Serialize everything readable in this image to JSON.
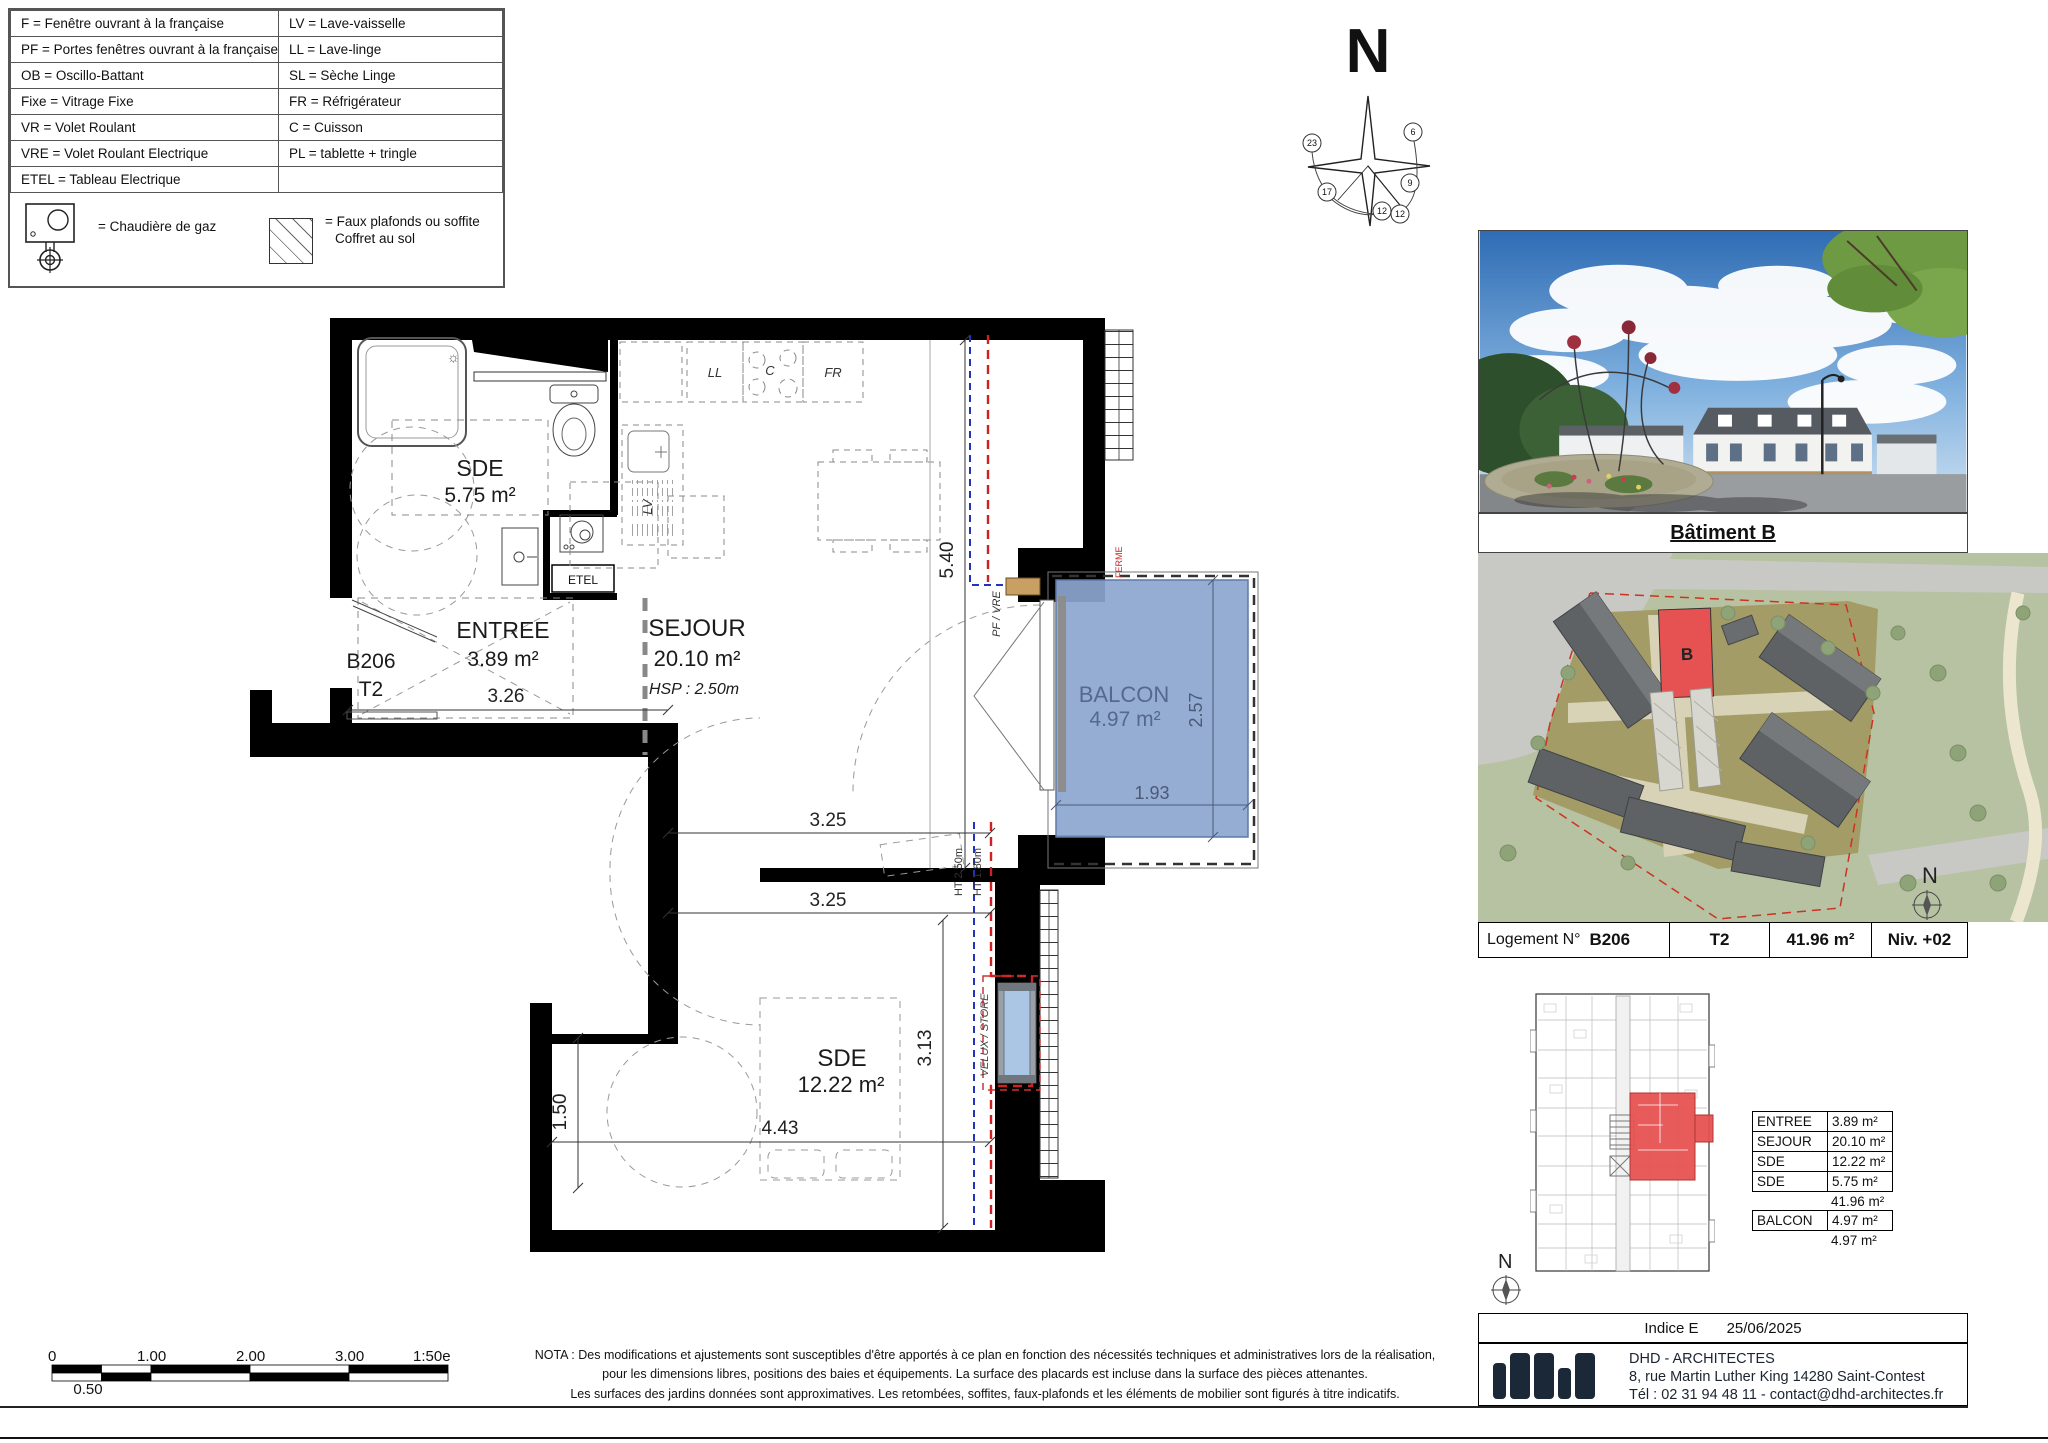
{
  "legend": {
    "rows": [
      {
        "left": "F = Fenêtre ouvrant à la française",
        "right": "LV = Lave-vaisselle"
      },
      {
        "left": "PF = Portes fenêtres ouvrant à la française",
        "right": "LL = Lave-linge"
      },
      {
        "left": "OB = Oscillo-Battant",
        "right": "SL = Sèche Linge"
      },
      {
        "left": "Fixe = Vitrage Fixe",
        "right": "FR = Réfrigérateur"
      },
      {
        "left": "VR = Volet Roulant",
        "right": "C = Cuisson"
      },
      {
        "left": "VRE = Volet Roulant Electrique",
        "right": "PL = tablette + tringle"
      },
      {
        "left": "ETEL = Tableau Electrique",
        "right": ""
      }
    ],
    "boiler": "= Chaudière de gaz",
    "soffit1": "= Faux plafonds ou soffite",
    "soffit2": "Coffret au sol"
  },
  "compass": {
    "north": "N",
    "h23": "23",
    "h6": "6",
    "h17": "17",
    "h9": "9",
    "h12a": "12",
    "h12b": "12"
  },
  "plan": {
    "unit_code": "B206",
    "unit_type": "T2",
    "sde1_name": "SDE",
    "sde1_area": "5.75 m²",
    "entree_name": "ENTREE",
    "entree_area": "3.89 m²",
    "sejour_name": "SEJOUR",
    "sejour_area": "20.10 m²",
    "sejour_hsp": "HSP : 2.50m",
    "sde2_name": "SDE",
    "sde2_area": "12.22 m²",
    "balcon_name": "BALCON",
    "balcon_area": "4.97 m²",
    "etel": "ETEL",
    "ll": "LL",
    "c": "C",
    "fr": "FR",
    "lv": "LV",
    "pf_vre": "PF / VRE",
    "velux": "VELUX / STORE",
    "ferme": "FERME",
    "ht1": "HT 2.50m",
    "ht2": "HT 1.80m",
    "d326": "3.26",
    "d540": "5.40",
    "d325a": "3.25",
    "d325b": "3.25",
    "d313": "3.13",
    "d443": "4.43",
    "d150": "1.50",
    "d257": "2.57",
    "d193": "1.93",
    "sun": "☼"
  },
  "scalebar": {
    "t0": "0",
    "t1": "1.00",
    "t2": "2.00",
    "t3": "3.00",
    "ratio": "1:50e",
    "half": "0.50"
  },
  "nota": {
    "l1": "NOTA : Des modifications et ajustements sont susceptibles d'être apportés à ce plan en fonction des nécessités techniques et administratives lors de la réalisation,",
    "l2": "pour les dimensions libres, positions des baies et équipements. La surface des placards est incluse dans la surface des pièces attenantes.",
    "l3": "Les surfaces des jardins données sont approximatives. Les retombées, soffites, faux-plafonds et les éléments de mobilier sont figurés à titre indicatifs."
  },
  "panel": {
    "title": "Bâtiment B",
    "site_b": "B",
    "site_n": "N",
    "keyplan_n": "N",
    "info": {
      "label": "Logement N°",
      "num": "B206",
      "type": "T2",
      "area": "41.96 m²",
      "level": "Niv. +02"
    },
    "areas": [
      {
        "label": "ENTREE",
        "value": "3.89 m²"
      },
      {
        "label": "SEJOUR",
        "value": "20.10 m²"
      },
      {
        "label": "SDE",
        "value": "12.22 m²"
      },
      {
        "label": "SDE",
        "value": "5.75 m²"
      }
    ],
    "total1": "41.96 m²",
    "balcon_label": "BALCON",
    "balcon_value": "4.97 m²",
    "total2": "4.97 m²",
    "indice_label": "Indice E",
    "indice_date": "25/06/2025",
    "firm_name": "DHD - ARCHITECTES",
    "firm_address": "8, rue Martin Luther King 14280 Saint-Contest",
    "firm_tel": "Tél : 02 31 94 48 11 - contact@dhd-architectes.fr"
  },
  "colors": {
    "wall": "#000000",
    "balcony_fill": "#8ca6cf",
    "red_unit": "#e65252",
    "utility_blue": "#2233bb",
    "utility_red": "#cc2222"
  }
}
